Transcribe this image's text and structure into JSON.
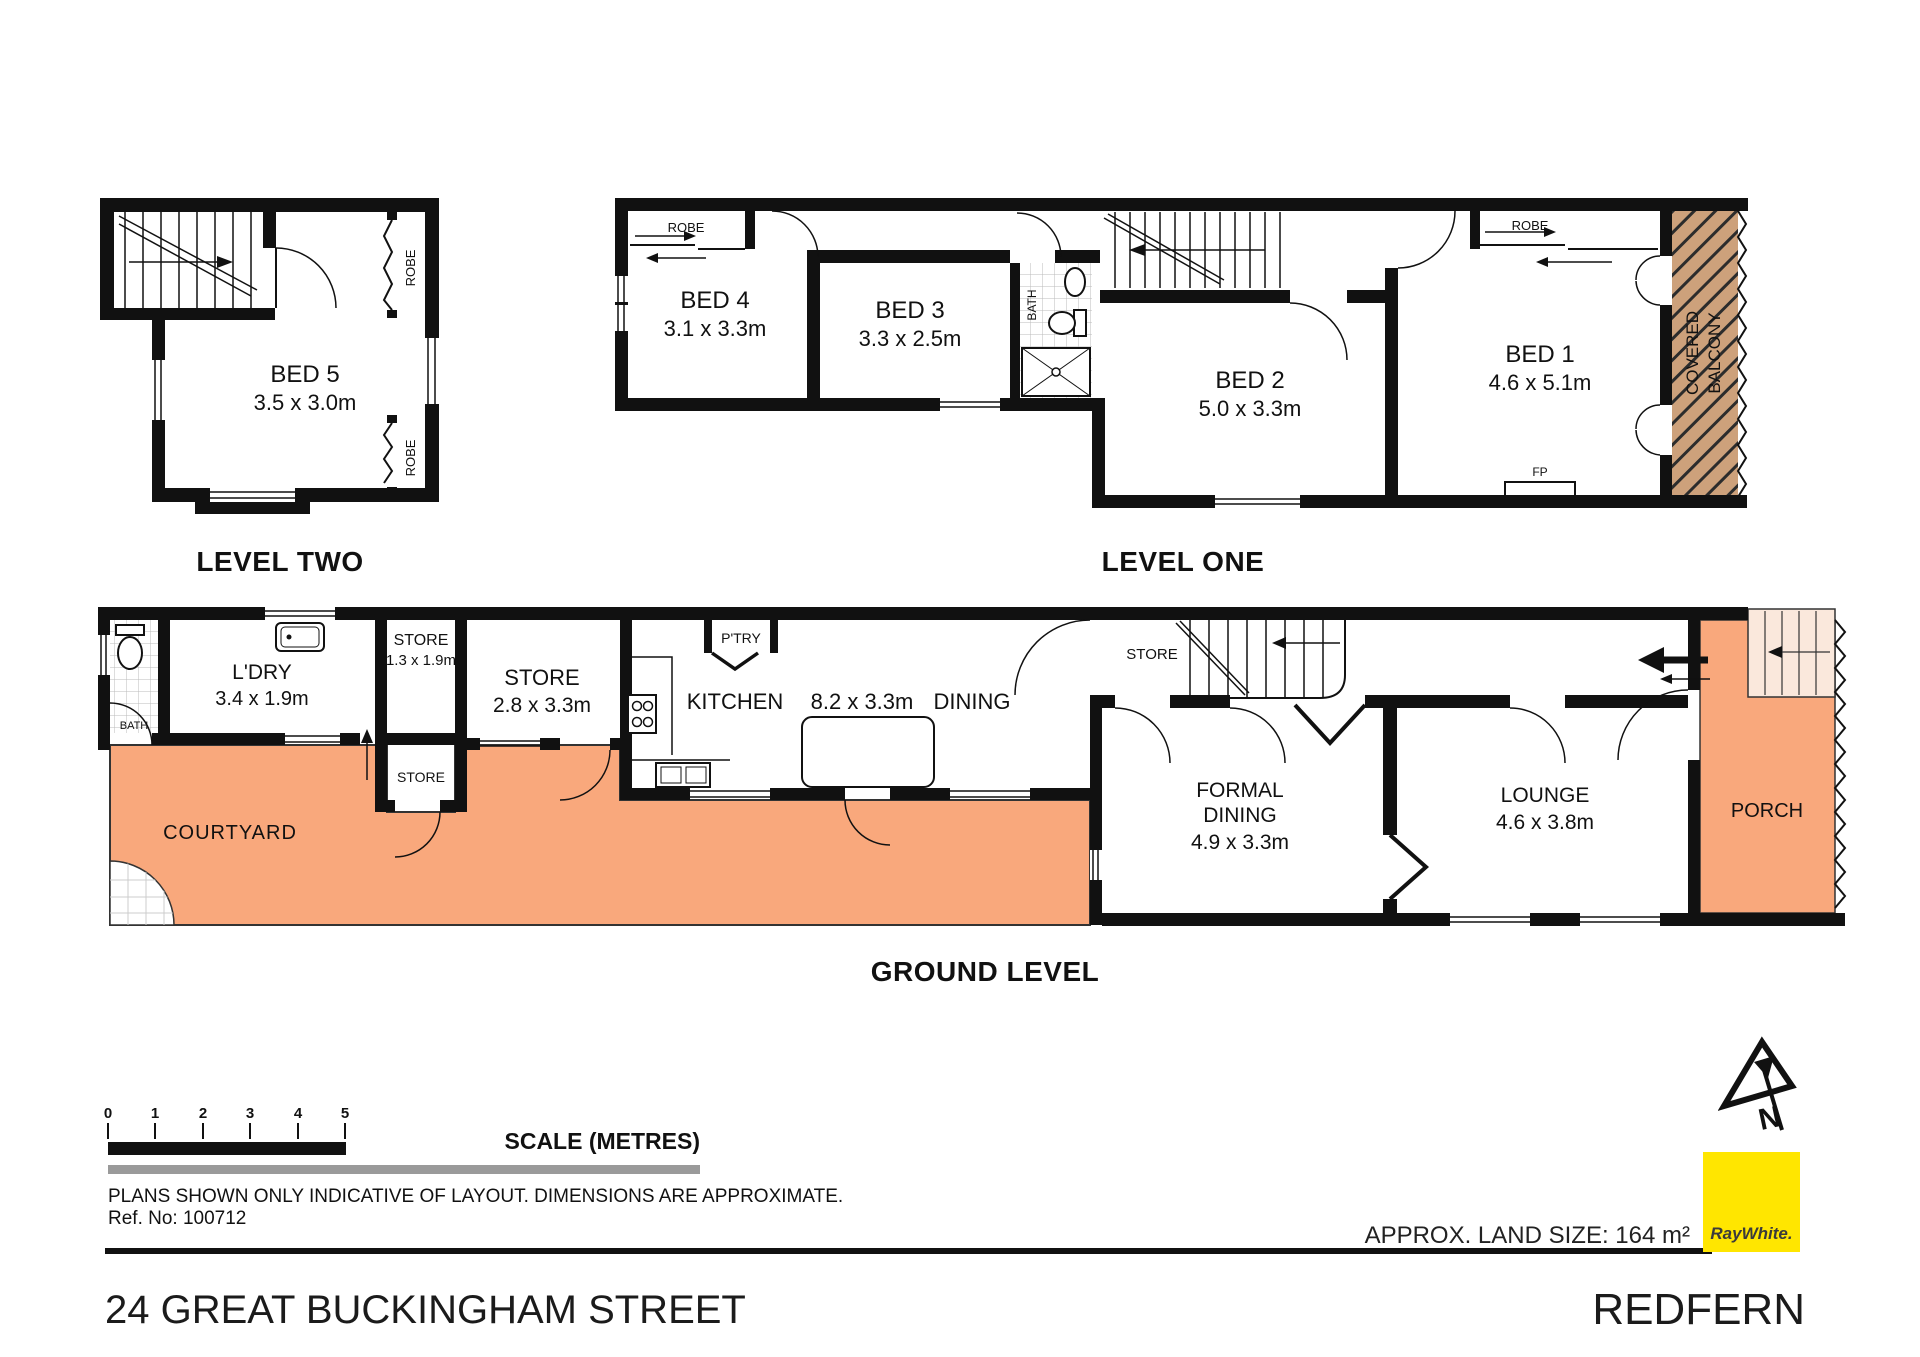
{
  "meta": {
    "address": "24 GREAT BUCKINGHAM STREET",
    "suburb": "REDFERN",
    "land_size": "APPROX. LAND SIZE: 164 m²",
    "ref": "Ref. No: 100712",
    "disclaimer": "PLANS SHOWN ONLY INDICATIVE OF LAYOUT.  DIMENSIONS ARE APPROXIMATE.",
    "brand": "RayWhite.",
    "north_letter": "N"
  },
  "scale": {
    "title": "SCALE (METRES)",
    "ticks": [
      "0",
      "1",
      "2",
      "3",
      "4",
      "5"
    ]
  },
  "levels": {
    "two": {
      "label": "LEVEL TWO",
      "bed5": {
        "name": "BED 5",
        "dims": "3.5 x 3.0m"
      },
      "robe": "ROBE"
    },
    "one": {
      "label": "LEVEL ONE",
      "bed4": {
        "name": "BED 4",
        "dims": "3.1 x 3.3m"
      },
      "bed3": {
        "name": "BED 3",
        "dims": "3.3 x 2.5m"
      },
      "bed2": {
        "name": "BED 2",
        "dims": "5.0 x 3.3m"
      },
      "bed1": {
        "name": "BED 1",
        "dims": "4.6 x 5.1m"
      },
      "bath": "BATH",
      "robe": "ROBE",
      "fp": "FP",
      "balcony_line1": "COVERED",
      "balcony_line2": "BALCONY"
    },
    "ground": {
      "label": "GROUND LEVEL",
      "bath": "BATH",
      "ldry": {
        "name": "L'DRY",
        "dims": "3.4 x 1.9m"
      },
      "store_small": {
        "name": "STORE",
        "dims": "1.3 x 1.9m"
      },
      "store_lower": "STORE",
      "store_big": {
        "name": "STORE",
        "dims": "2.8 x 3.3m"
      },
      "pantry": "P'TRY",
      "kitchen": "KITCHEN",
      "kitchen_dims": "8.2 x 3.3m",
      "dining": "DINING",
      "store_stairs": "STORE",
      "formal_dining": {
        "line1": "FORMAL",
        "line2": "DINING",
        "dims": "4.9 x 3.3m"
      },
      "lounge": {
        "name": "LOUNGE",
        "dims": "4.6 x 3.8m"
      },
      "courtyard": "COURTYARD",
      "porch": "PORCH"
    }
  },
  "colors": {
    "outdoor": "#F9A87C",
    "balcony": "#CDA17B",
    "wall": "#111111",
    "brand_yellow": "#FFE600",
    "steps": "#FAE8DC"
  }
}
